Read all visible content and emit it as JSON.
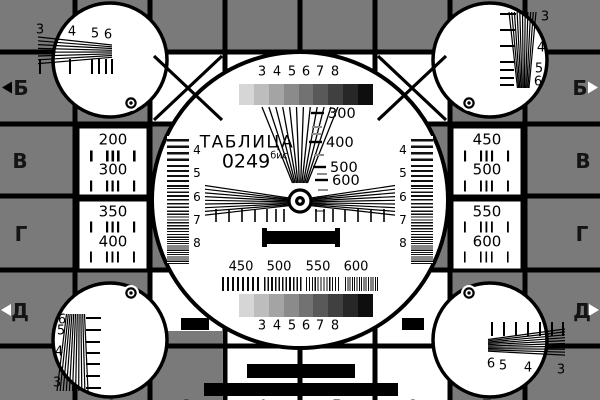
{
  "colors": {
    "background": "#7a7a7a",
    "ink": "#000000",
    "white": "#ffffff"
  },
  "title": {
    "name": "ТАБЛИЦА",
    "number": "0249",
    "suffix": "бис"
  },
  "rows": {
    "left": {
      "b": "Б",
      "v": "В",
      "g": "Г",
      "d": "Д"
    },
    "right": {
      "b": "Б",
      "v": "В",
      "g": "Г",
      "d": "Д"
    }
  },
  "edge_digits": {
    "top": [
      "2",
      "3",
      "4",
      "5",
      "6",
      "7"
    ],
    "bottom": [
      "2",
      "3",
      "4",
      "5",
      "6",
      "7"
    ]
  },
  "boxes": {
    "left_top": [
      "200",
      "300"
    ],
    "left_bottom": [
      "350",
      "400"
    ],
    "right_top": [
      "450",
      "500"
    ],
    "right_bottom": [
      "550",
      "600"
    ]
  },
  "circle": {
    "top_scale": [
      "3",
      "4",
      "5",
      "6",
      "7",
      "8"
    ],
    "bottom_scale": [
      "3",
      "4",
      "5",
      "6",
      "7",
      "8"
    ],
    "wedge_marks": [
      "300",
      "400",
      "500",
      "600"
    ],
    "burst_marks": [
      "450",
      "500",
      "550",
      "600"
    ],
    "side_marks_left": [
      "4",
      "5",
      "6",
      "7",
      "8"
    ],
    "side_marks_right": [
      "4",
      "5",
      "6",
      "7",
      "8"
    ],
    "grayscale_top": [
      "#d6d6d6",
      "#bdbdbd",
      "#a4a4a4",
      "#8b8b8b",
      "#727272",
      "#595959",
      "#404040",
      "#272727",
      "#0e0e0e"
    ],
    "grayscale_bottom": [
      "#d6d6d6",
      "#bdbdbd",
      "#a4a4a4",
      "#8b8b8b",
      "#727272",
      "#595959",
      "#404040",
      "#272727",
      "#0e0e0e"
    ]
  },
  "corners": {
    "top_left": [
      "3",
      "4",
      "5",
      "6"
    ],
    "top_right": [
      "3",
      "4",
      "5",
      "6"
    ],
    "bottom_left": [
      "6",
      "5",
      "4",
      "3"
    ],
    "bottom_right": [
      "6",
      "5",
      "4",
      "3"
    ]
  }
}
